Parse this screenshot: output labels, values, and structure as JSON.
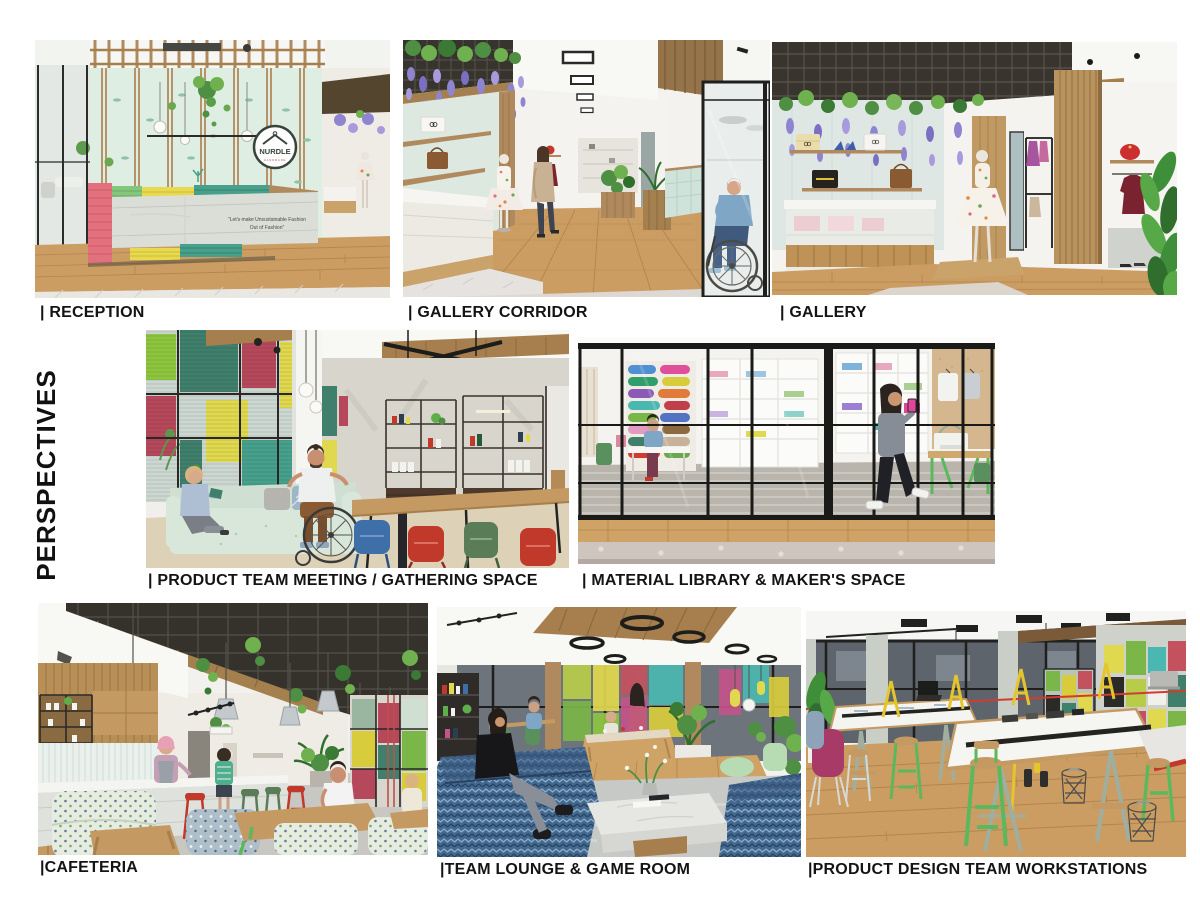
{
  "page": {
    "title": "PERSPECTIVES",
    "background": "#ffffff"
  },
  "panels": [
    {
      "id": "reception",
      "label": "| RECEPTION"
    },
    {
      "id": "gallery-corridor",
      "label": "| GALLERY CORRIDOR"
    },
    {
      "id": "gallery",
      "label": "| GALLERY"
    },
    {
      "id": "product-team-meeting",
      "label": "| PRODUCT TEAM MEETING / GATHERING SPACE"
    },
    {
      "id": "material-library",
      "label": "| MATERIAL LIBRARY & MAKER'S SPACE"
    },
    {
      "id": "cafeteria",
      "label": "|CAFETERIA"
    },
    {
      "id": "team-lounge",
      "label": "|TEAM LOUNGE & GAME ROOM"
    },
    {
      "id": "workstations",
      "label": "|PRODUCT DESIGN TEAM WORKSTATIONS"
    }
  ],
  "reception": {
    "logo_text": "NURDLE",
    "logo_subtext": "HANDMADE",
    "quote_line1": "\"Let's make Unsustainable Fashion",
    "quote_line2": "Out of Fashion\""
  },
  "palette": {
    "coral": "#e2717d",
    "crimson": "#b5495b",
    "yellow": "#e3d54b",
    "teal": "#46a08b",
    "lime_green": "#8cc63f",
    "mint_wall": "#dcebe0",
    "wood": "#c49a62",
    "floor_wood": "#cb9d63",
    "wisteria": "#8e84cf",
    "leaf_green": "#5f9b4e",
    "dark_ceiling": "#37332d",
    "denim_blue": "#4a6e9e",
    "label_ink": "#141414"
  }
}
